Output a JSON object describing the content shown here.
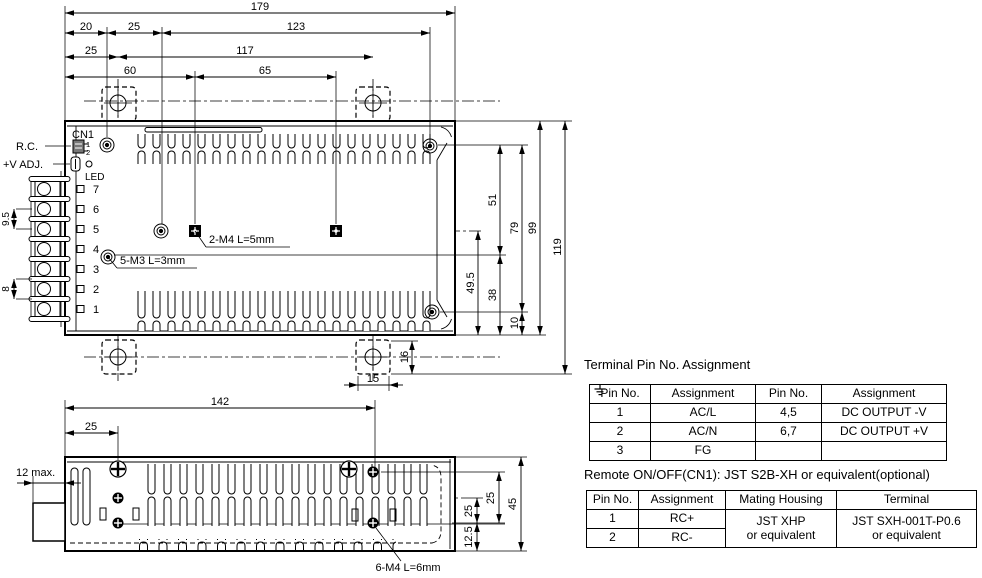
{
  "tv": {
    "d179": "179",
    "d20": "20",
    "d25a": "25",
    "d123": "123",
    "d25b": "25",
    "d117": "117",
    "d60": "60",
    "d65": "65",
    "d51": "51",
    "d79": "79",
    "d99": "99",
    "d119": "119",
    "d495": "49.5",
    "d38": "38",
    "d10": "10",
    "d16": "16",
    "d15": "15",
    "d95": "9.5",
    "d8": "8",
    "m4_label": "2-M4 L=5mm",
    "m3_label": "5-M3 L=3mm",
    "cn1": "CN1",
    "cn1_pin1": "1",
    "cn1_pin2": "2",
    "rc": "R.C.",
    "vadj": "+V ADJ.",
    "led": "LED",
    "pins": [
      "7",
      "6",
      "5",
      "4",
      "3",
      "2",
      "1"
    ]
  },
  "sv": {
    "d142": "142",
    "d25": "25",
    "d12max": "12 max.",
    "d25a": "25",
    "d25b": "25",
    "d45": "45",
    "d125": "12.5",
    "m4_label": "6-M4 L=6mm"
  },
  "t1": {
    "title": "Terminal Pin No.  Assignment",
    "headers": [
      "Pin No.",
      "Assignment",
      "Pin No.",
      "Assignment"
    ],
    "rows": [
      [
        "1",
        "AC/L",
        "4,5",
        "DC OUTPUT -V"
      ],
      [
        "2",
        "AC/N",
        "6,7",
        "DC OUTPUT +V"
      ],
      [
        "3",
        "FG",
        "",
        ""
      ]
    ]
  },
  "t2": {
    "title": "Remote ON/OFF(CN1): JST S2B-XH or equivalent(optional)",
    "headers": [
      "Pin No.",
      "Assignment",
      "Mating Housing",
      "Terminal"
    ],
    "rows": [
      [
        "1",
        "RC+"
      ],
      [
        "2",
        "RC-"
      ]
    ],
    "housing": [
      "JST XHP",
      "or equivalent"
    ],
    "terminal": [
      "JST SXH-001T-P0.6",
      "or equivalent"
    ]
  }
}
